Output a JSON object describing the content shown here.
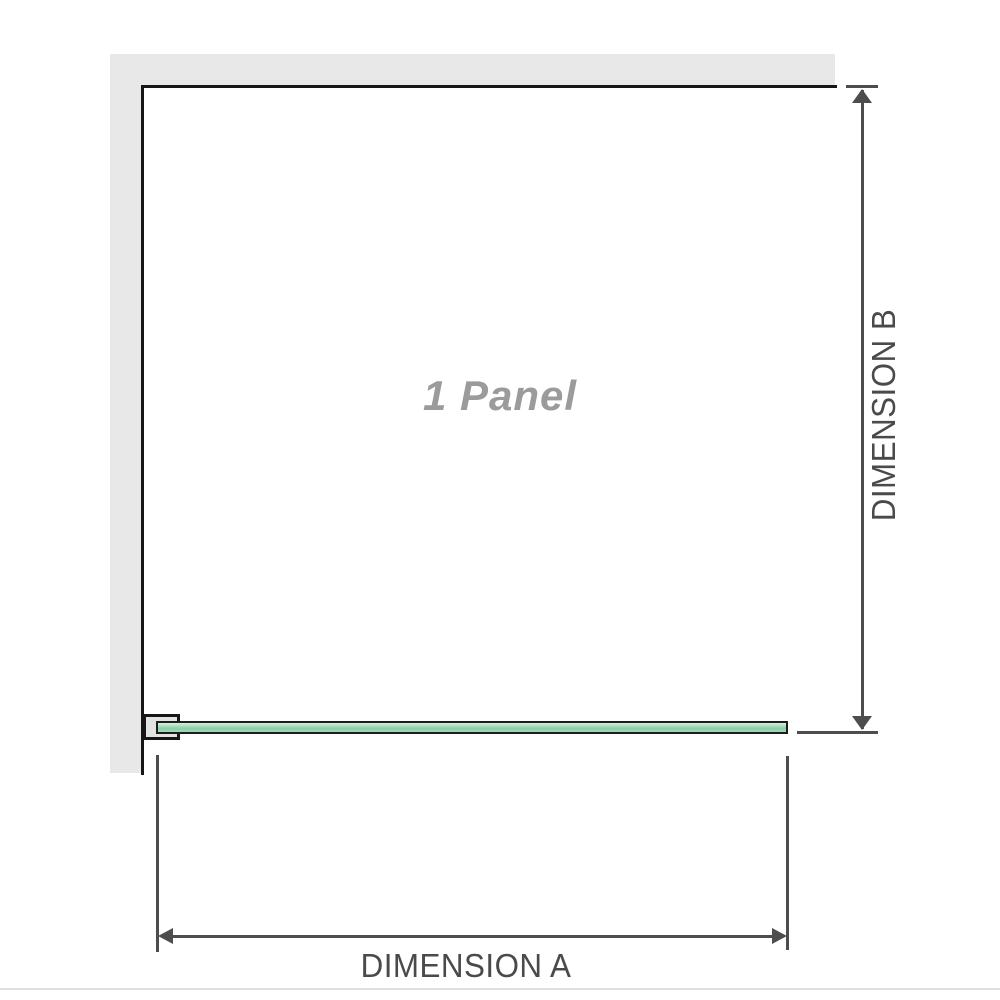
{
  "diagram": {
    "panel_label": "1 Panel",
    "dimension_a_label": "DIMENSION A",
    "dimension_b_label": "DIMENSION B"
  },
  "colors": {
    "wall_fill": "#e8e8e8",
    "outline": "#161616",
    "glass_fill": "#9fd8b4",
    "glass_highlight": "#d9efe1",
    "glass_border": "#1d1d1d",
    "bracket_fill": "#e3e3e3",
    "dimension_line": "#4d4d4d",
    "dimension_text": "#4a4a4a",
    "panel_label_text": "#9b9b9b",
    "separator_line": "#dfdfdf"
  }
}
